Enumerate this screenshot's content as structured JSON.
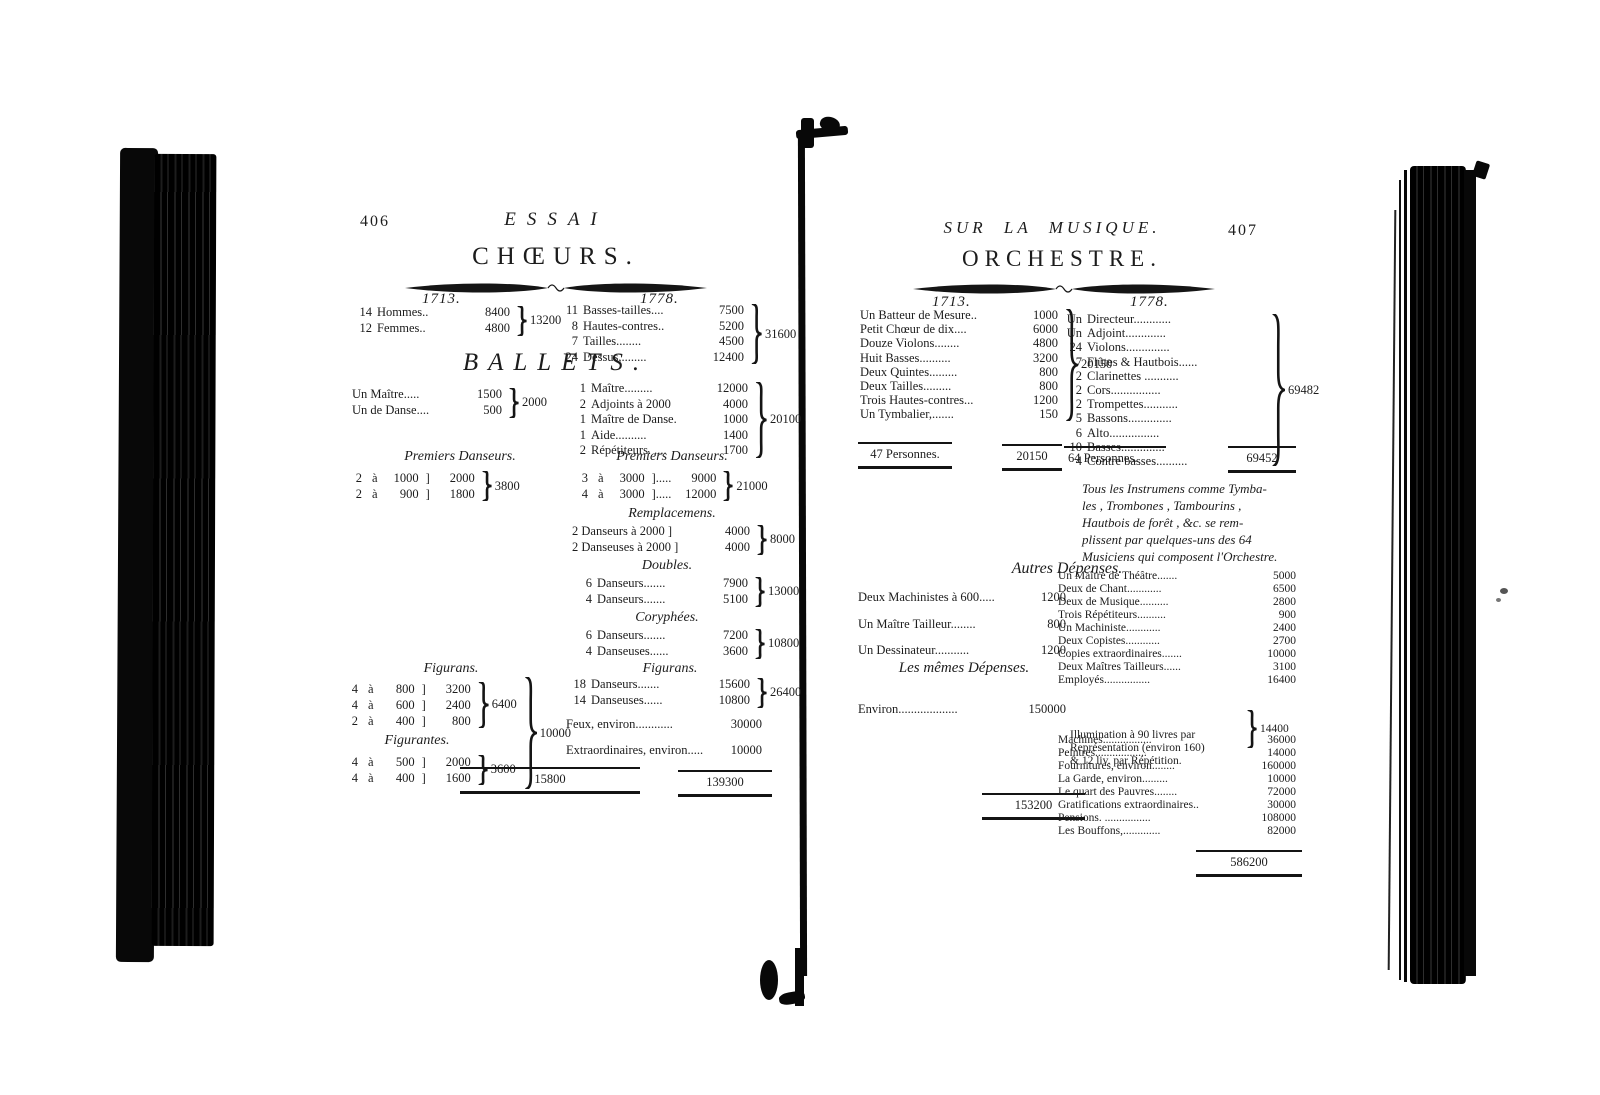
{
  "colors": {
    "ink": "#1c1c1c",
    "paper": "#ffffff"
  },
  "left_page": {
    "page_number": "406",
    "running_title": "ESSAI",
    "choeurs": {
      "title": "CHŒURS.",
      "year_1713": "1713.",
      "year_1778": "1778.",
      "g1713": {
        "rows": [
          {
            "n": "14",
            "label": "Hommes..",
            "amount": "8400"
          },
          {
            "n": "12",
            "label": "Femmes..",
            "amount": "4800"
          }
        ],
        "total": "13200"
      },
      "g1778": {
        "rows": [
          {
            "n": "11",
            "label": "Basses-tailles....",
            "amount": "7500"
          },
          {
            "n": "8",
            "label": "Hautes-contres..",
            "amount": "5200"
          },
          {
            "n": "7",
            "label": "Tailles........",
            "amount": "4500"
          },
          {
            "n": "24",
            "label": "Dessus,........",
            "amount": "12400"
          }
        ],
        "total": "31600"
      }
    },
    "ballets": {
      "title": "BALLETS.",
      "g1713": {
        "rows": [
          {
            "label": "Un Maître.....",
            "amount": "1500"
          },
          {
            "label": "Un de Danse....",
            "amount": "500"
          }
        ],
        "total": "2000"
      },
      "g1778": {
        "rows": [
          {
            "n": "1",
            "label": "Maître.........",
            "amount": "12000"
          },
          {
            "n": "2",
            "label": "Adjoints à 2000",
            "amount": "4000"
          },
          {
            "n": "1",
            "label": "Maître de Danse.",
            "amount": "1000"
          },
          {
            "n": "1",
            "label": "Aide..........",
            "amount": "1400"
          },
          {
            "n": "2",
            "label": "Répétiteurs. ....",
            "amount": "1700"
          }
        ],
        "total": "20100"
      },
      "premiers_heading_left": "Premiers Danseurs.",
      "premiers_heading_right": "Premiers Danseurs.",
      "pd1713": {
        "rows": [
          {
            "n": "2",
            "a": "à",
            "rate": "1000",
            "br": "]",
            "sub": "2000"
          },
          {
            "n": "2",
            "a": "à",
            "rate": "900",
            "br": "]",
            "sub": "1800"
          }
        ],
        "total": "3800"
      },
      "pd1778": {
        "rows": [
          {
            "n": "3",
            "a": "à",
            "rate": "3000",
            "br": "].....",
            "sub": "9000"
          },
          {
            "n": "4",
            "a": "à",
            "rate": "3000",
            "br": "].....",
            "sub": "12000"
          }
        ],
        "total": "21000"
      },
      "remplacemens_heading": "Remplacemens.",
      "remplacemens": {
        "rows": [
          {
            "label": "2 Danseurs à 2000 ]",
            "amount": "4000"
          },
          {
            "label": "2 Danseuses à 2000 ]",
            "amount": "4000"
          }
        ],
        "total": "8000"
      },
      "doubles_heading": "Doubles.",
      "doubles": {
        "rows": [
          {
            "n": "6",
            "label": "Danseurs.......",
            "amount": "7900"
          },
          {
            "n": "4",
            "label": "Danseurs.......",
            "amount": "5100"
          }
        ],
        "total": "13000"
      },
      "coryphees_heading": "Coryphées.",
      "coryphees": {
        "rows": [
          {
            "n": "6",
            "label": "Danseurs.......",
            "amount": "7200"
          },
          {
            "n": "4",
            "label": "Danseuses......",
            "amount": "3600"
          }
        ],
        "total": "10800"
      },
      "figurans_1713_heading": "Figurans.",
      "figurans1713": {
        "rows": [
          {
            "n": "4",
            "a": "à",
            "rate": "800",
            "br": "]",
            "sub": "3200"
          },
          {
            "n": "4",
            "a": "à",
            "rate": "600",
            "br": "]",
            "sub": "2400"
          },
          {
            "n": "2",
            "a": "à",
            "rate": "400",
            "br": "]",
            "sub": "800"
          }
        ],
        "total": "6400"
      },
      "figurantes_heading": "Figurantes.",
      "figurantes": {
        "rows": [
          {
            "n": "4",
            "a": "à",
            "rate": "500",
            "br": "]",
            "sub": "2000"
          },
          {
            "n": "4",
            "a": "à",
            "rate": "400",
            "br": "]",
            "sub": "1600"
          }
        ],
        "total": "3600"
      },
      "figurans_combined_total": "10000",
      "total_1713": "15800",
      "figurans_1778_heading": "Figurans.",
      "figurans1778": {
        "rows": [
          {
            "n": "18",
            "label": "Danseurs.......",
            "amount": "15600"
          },
          {
            "n": "14",
            "label": "Danseuses......",
            "amount": "10800"
          }
        ],
        "total": "26400"
      },
      "feux": {
        "label": "Feux, environ............",
        "amount": "30000"
      },
      "extraordinaires": {
        "label": "Extraordinaires, environ.....",
        "amount": "10000"
      },
      "total_1778": "139300"
    }
  },
  "right_page": {
    "page_number": "407",
    "running_title": "SUR LA MUSIQUE.",
    "orchestre": {
      "title": "ORCHESTRE.",
      "year_1713": "1713.",
      "year_1778": "1778.",
      "g1713": {
        "rows": [
          {
            "label": "Un Batteur de Mesure..",
            "amount": "1000"
          },
          {
            "label": "Petit Chœur de dix....",
            "amount": "6000"
          },
          {
            "label": "Douze Violons........",
            "amount": "4800"
          },
          {
            "label": "Huit Basses..........",
            "amount": "3200"
          },
          {
            "label": "Deux Quintes.........",
            "amount": "800"
          },
          {
            "label": "Deux Tailles.........",
            "amount": "800"
          },
          {
            "label": "Trois Hautes-contres...",
            "amount": "1200"
          },
          {
            "label": "Un Tymbalier,.......",
            "amount": "150"
          }
        ],
        "total": "20150"
      },
      "g1778": {
        "rows": [
          {
            "n": "Un",
            "label": "Directeur............"
          },
          {
            "n": "Un",
            "label": "Adjoint............."
          },
          {
            "n": "24",
            "label": "Violons.............."
          },
          {
            "n": "7",
            "label": "Flûtes & Hautbois......"
          },
          {
            "n": "2",
            "label": "Clarinettes ..........."
          },
          {
            "n": "2",
            "label": "Cors................"
          },
          {
            "n": "2",
            "label": "Trompettes..........."
          },
          {
            "n": "5",
            "label": "Bassons.............."
          },
          {
            "n": "6",
            "label": "Alto................"
          },
          {
            "n": "10",
            "label": "Basses.............."
          },
          {
            "n": "4",
            "label": "Contre basses.........."
          }
        ],
        "total": "69482"
      },
      "personnes_1713": {
        "label": "47 Personnes.",
        "amount": "20150"
      },
      "personnes_1778": {
        "label": "64 Personnes.",
        "amount": "69452"
      },
      "note_lines": [
        "Tous les Instrumens comme Tymba-",
        "les , Trombones , Tambourins ,",
        "Hautbois de forêt , &c. se rem-",
        "plissent par quelques-uns des 64",
        "Musiciens qui composent l'Orchestre."
      ]
    },
    "autres": {
      "title": "Autres Dépenses.",
      "g1713": {
        "rows": [
          {
            "label": "Deux Machinistes à 600.....",
            "amount": "1200"
          },
          {
            "label": "Un Maître Tailleur........",
            "amount": "800"
          },
          {
            "label": "Un Dessinateur...........",
            "amount": "1200"
          }
        ]
      },
      "memes_title": "Les mêmes Dépenses.",
      "environ": {
        "label": "Environ...................",
        "amount": "150000"
      },
      "total_1713": "153200",
      "g1778_before": [
        {
          "label": "Un Maître de Théâtre.......",
          "amount": "5000"
        },
        {
          "label": "Deux de Chant............",
          "amount": "6500"
        },
        {
          "label": "Deux de Musique..........",
          "amount": "2800"
        },
        {
          "label": "Trois Répétiteurs..........",
          "amount": "900"
        },
        {
          "label": "Un Machiniste............",
          "amount": "2400"
        },
        {
          "label": "Deux Copistes............",
          "amount": "2700"
        },
        {
          "label": "Copies extraordinaires.......",
          "amount": "10000"
        },
        {
          "label": "Deux Maîtres Tailleurs......",
          "amount": "3100"
        },
        {
          "label": "Employés................",
          "amount": "16400"
        }
      ],
      "illumination": {
        "lines": [
          "Illumination à 90 livres par",
          "Représentation (environ 160)",
          "& 12 liv. par Répétition."
        ],
        "amount": "14400"
      },
      "g1778_after": [
        {
          "label": "Machines.................",
          "amount": "36000"
        },
        {
          "label": "Peintres..................",
          "amount": "14000"
        },
        {
          "label": "Fournitures, environ........",
          "amount": "160000"
        },
        {
          "label": "La Garde, environ.........",
          "amount": "10000"
        },
        {
          "label": "Le quart des Pauvres........",
          "amount": "72000"
        },
        {
          "label": "Gratifications extraordinaires..",
          "amount": "30000"
        },
        {
          "label": "Pensions. ................",
          "amount": "108000"
        },
        {
          "label": "Les Bouffons,.............",
          "amount": "82000"
        }
      ],
      "total_1778": "586200"
    }
  }
}
